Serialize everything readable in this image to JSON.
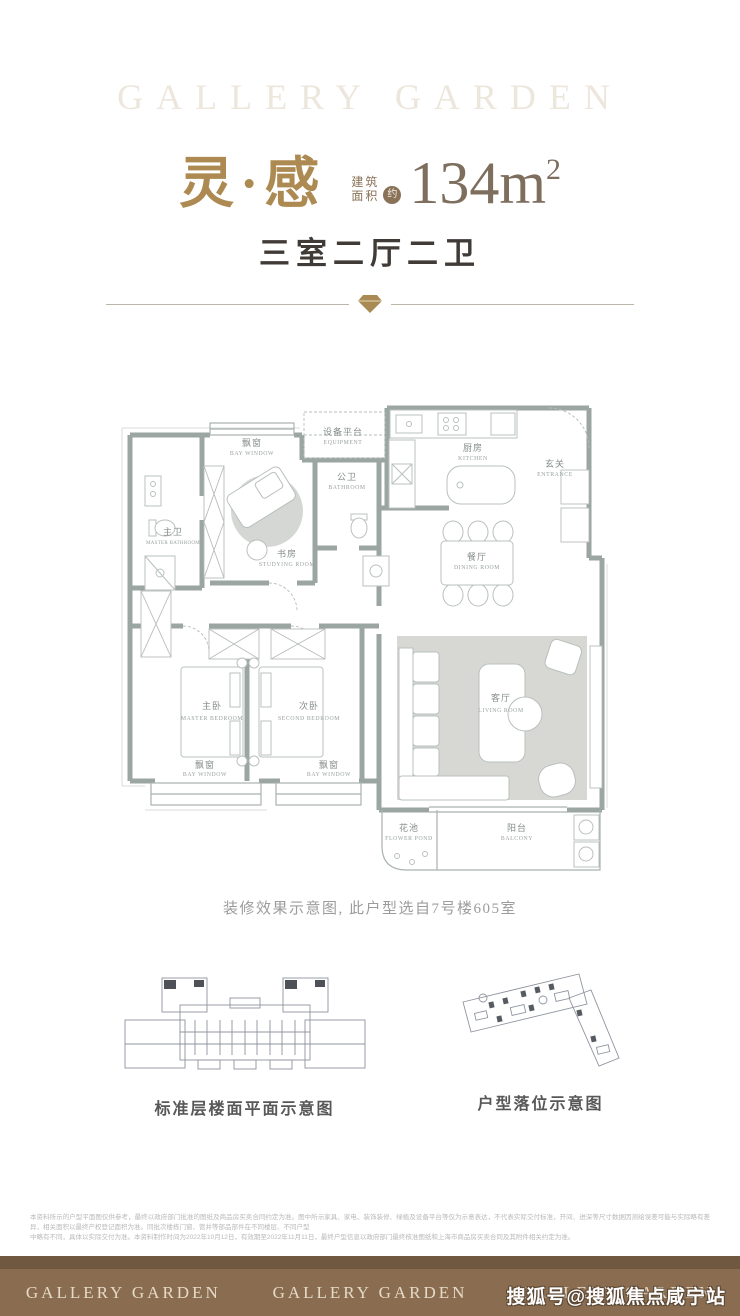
{
  "header": {
    "brand_watermark": "GALLERY GARDEN",
    "title": "灵·感",
    "area_prefix_line1": "建筑",
    "area_prefix_line2": "面积",
    "area_approx_badge": "约",
    "area_value": "134m",
    "area_superscript": "2",
    "subtitle": "三室二厅二卫"
  },
  "floorplan": {
    "rooms": [
      {
        "id": "bay-window-top",
        "cn": "飘窗",
        "en": "BAY WINDOW"
      },
      {
        "id": "equipment",
        "cn": "设备平台",
        "en": "EQUIPMENT"
      },
      {
        "id": "bathroom",
        "cn": "公卫",
        "en": "BATHROOM"
      },
      {
        "id": "kitchen",
        "cn": "厨房",
        "en": "KITCHEN"
      },
      {
        "id": "entrance",
        "cn": "玄关",
        "en": "ENTRANCE"
      },
      {
        "id": "master-bathroom",
        "cn": "主卫",
        "en": "MASTER BATHROOM"
      },
      {
        "id": "studying-room",
        "cn": "书房",
        "en": "STUDYING ROOM"
      },
      {
        "id": "dining-room",
        "cn": "餐厅",
        "en": "DINING ROOM"
      },
      {
        "id": "master-bedroom",
        "cn": "主卧",
        "en": "MASTER BEDROOM"
      },
      {
        "id": "second-bedroom",
        "cn": "次卧",
        "en": "SECOND BEDROOM"
      },
      {
        "id": "living-room",
        "cn": "客厅",
        "en": "LIVING ROOM"
      },
      {
        "id": "bay-window-left",
        "cn": "飘窗",
        "en": "BAY WINDOW"
      },
      {
        "id": "bay-window-mid",
        "cn": "飘窗",
        "en": "BAY WINDOW"
      },
      {
        "id": "flower-pond",
        "cn": "花池",
        "en": "FLOWER POND"
      },
      {
        "id": "balcony",
        "cn": "阳台",
        "en": "BALCONY"
      }
    ]
  },
  "caption": {
    "text": "装修效果示意图, 此户型选自7号楼605室"
  },
  "diagrams": {
    "left_label": "标准层楼面平面示意图",
    "right_label": "户型落位示意图"
  },
  "disclaimer": {
    "line1": "本资料所示的户型平面图仅供参考，最终以政府部门批准的图纸及商品房买卖合同约定为准。图中所示家具、家电、装饰装修、绿植及设备平台等仅为示意表达，不代表实际交付标准，开间、进深等尺寸数据因测绘误差可能与实际略有差异，相关面积以最终产权登记面积为准。同批次楼栋门窗、管井等部品部件在不同楼层、不同户型",
    "line2": "中略有不同，具体以实际交付为准。本资料制作时间为2022年10月12日，有效期至2022年11月11日，最终户型信息以政府部门最终核准图纸和上海市商品房买卖合同及其附件相关约定为准。"
  },
  "footer": {
    "brand_items": [
      "GALLERY GARDEN",
      "GALLERY GARDEN",
      "GALLERY GARDEN"
    ]
  },
  "watermark": {
    "text": "搜狐号@搜狐焦点咸宁站"
  },
  "colors": {
    "accent_gold": "#ac8a51",
    "headline_brown": "#7d6e5d",
    "wall_gray": "#9ba6a2",
    "rug_gray": "#d7d8d4",
    "footer_brown": "#8a6d50"
  }
}
